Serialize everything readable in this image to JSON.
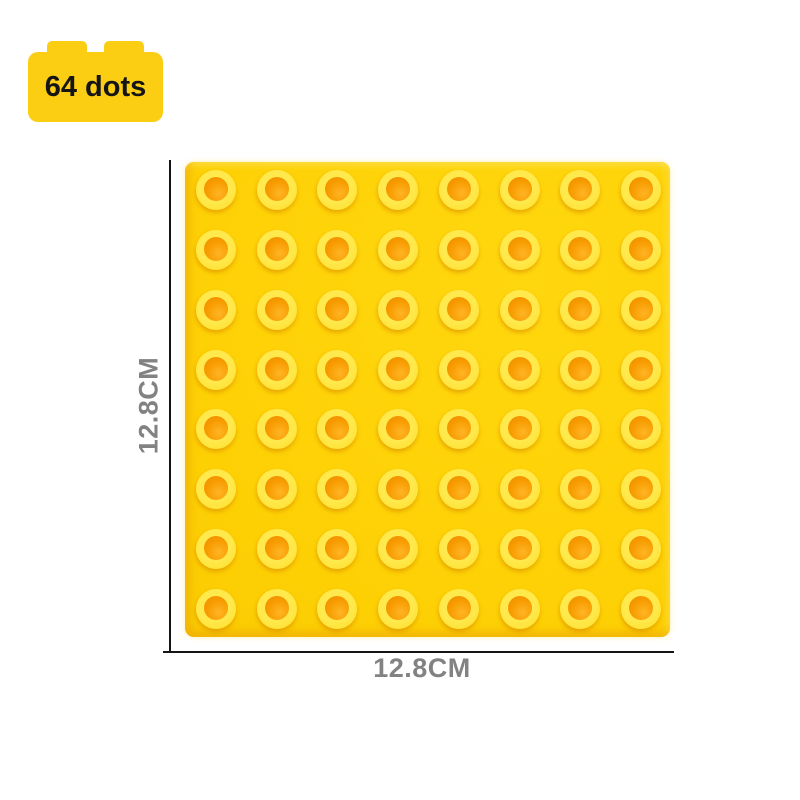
{
  "badge": {
    "label": "64 dots"
  },
  "plate": {
    "rows": 8,
    "cols": 8,
    "stud_count": 64
  },
  "dimensions": {
    "height_label": "12.8CM",
    "width_label": "12.8CM"
  },
  "colors": {
    "background": "#FFFFFF",
    "badge_color": "#FBCE13",
    "badge_text_color": "#151515",
    "plate_color": "#FDD004",
    "stud_ring_color": "#FFE43C",
    "stud_hole_color": "#F79B00",
    "line_color": "#151515",
    "dim_label_color": "#828282"
  }
}
